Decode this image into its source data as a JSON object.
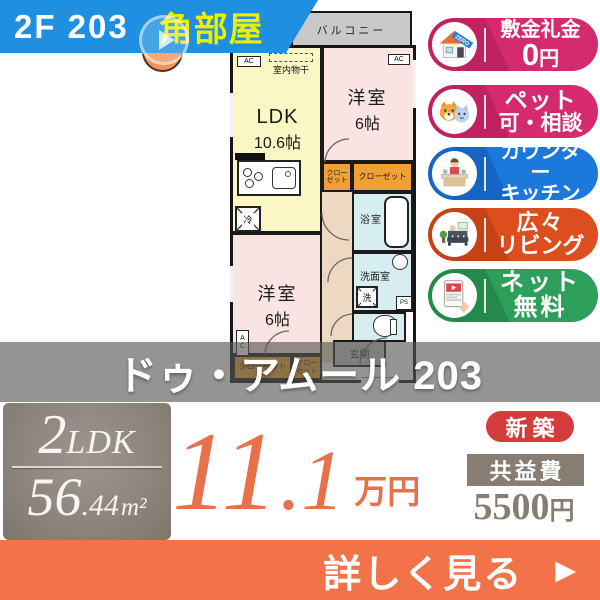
{
  "banner": {
    "unit": "2F 203",
    "corner": "角部屋"
  },
  "title_band": {
    "name": "ドゥ・アムール 203"
  },
  "floorplan": {
    "balcony": "バルコニー",
    "ac": "AC",
    "indoor_drying": "室内物干",
    "ldk_name": "LDK",
    "ldk_size": "10.6帖",
    "bedroom_name": "洋室",
    "bedroom_size": "6帖",
    "closet": "クローゼット",
    "closet_l1": "クロー",
    "closet_l2": "ゼット",
    "bath": "浴室",
    "washroom": "洗面室",
    "washer": "洗",
    "fridge": "冷",
    "ps": "PS",
    "entrance": "玄関"
  },
  "badges": [
    {
      "id": "no-deposit",
      "l1": "敷金礼金",
      "zero": "0",
      "yen": "円",
      "ribbon": "ZERO",
      "color": "#D52B6E"
    },
    {
      "id": "pets-ok",
      "l1": "ペット",
      "l2": "可・相談",
      "color": "#D52B6E"
    },
    {
      "id": "counter-kitchen",
      "l1": "カウンター",
      "l2": "キッチン",
      "color": "#1B79DB"
    },
    {
      "id": "spacious-living",
      "l1": "広々",
      "l2": "リビング",
      "color": "#DC4E1E"
    },
    {
      "id": "free-internet",
      "l1": "ネット",
      "l2": "無料",
      "color": "#2E9E5B"
    }
  ],
  "pricing": {
    "layout_num": "2",
    "layout_type": "LDK",
    "area_int": "56",
    "area_dec": ".44",
    "area_unit": "m²",
    "price_int": "11",
    "price_dec": ".1",
    "price_unit": "万円",
    "new_label": "新築",
    "fee_label": "共益費",
    "fee_amount": "5500",
    "fee_unit": "円"
  },
  "cta": {
    "label": "詳しく見る",
    "arrow": "▶"
  },
  "colors": {
    "banner_blue": "#1E8FE1",
    "corner_yellow": "#EDEE00",
    "badge_pink": "#D52B6E",
    "badge_blue": "#1B79DB",
    "badge_orange": "#DC4E1E",
    "badge_green": "#2E9E5B",
    "price_orange": "#E8714B",
    "cta_orange": "#F2734A",
    "new_red": "#D43C3C",
    "taupe_gray": "#877D73"
  }
}
